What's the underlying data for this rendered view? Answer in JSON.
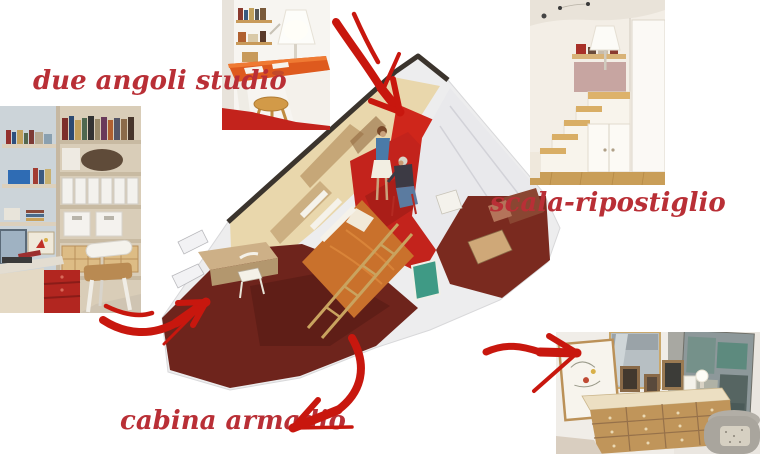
{
  "page": {
    "background": "#ffffff"
  },
  "labels": {
    "studio": "due angoli studio",
    "stairs": "scala-ripostiglio",
    "closet": "cabina armadio"
  },
  "colors": {
    "label_red": "#b92f36",
    "arrow_red": "#c8170e",
    "sketch_paper": "#ededee",
    "sketch_wall_cream": "#e9d7ac",
    "sketch_floor_maroon": "#6e241c",
    "sketch_floor_red": "#c3231c",
    "sketch_bed_orange": "#c9712c",
    "photo_floor_red": "#c3231c",
    "wood_tan": "#d9ae66"
  },
  "photos": [
    {
      "name": "photo-study-bookshelf",
      "desc": "study corner with bookshelves, desk, monitor, white chair and red drawer unit"
    },
    {
      "name": "photo-study-desk",
      "desc": "study corner with orange desk, white lamp, wall shelves and wooden stool on red floor"
    },
    {
      "name": "photo-stair-storage",
      "desc": "white staircase with wooden treads and built-in storage cupboards"
    },
    {
      "name": "photo-walk-in-closet",
      "desc": "walk-in closet corner with wooden chest of drawers, framed pictures, mirror and armchair"
    }
  ],
  "illustration": {
    "name": "apartment-sketch",
    "desc": "hand-painted axonometric sketch of the studio apartment with two figures, bed, ladder, desk and red floors"
  }
}
